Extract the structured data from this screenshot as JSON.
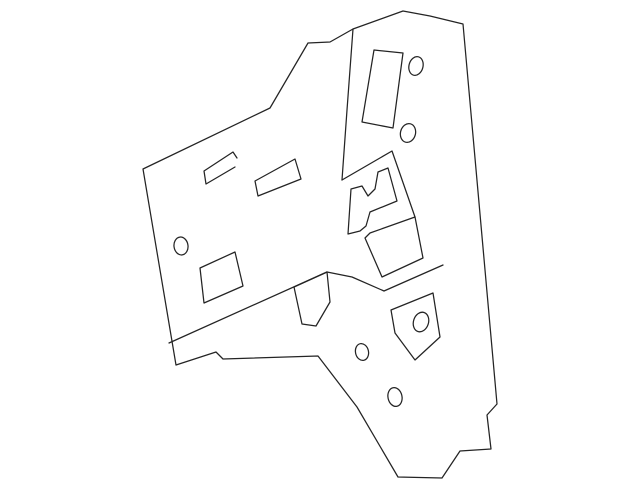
{
  "page": {
    "background_color": "#ffffff",
    "line_color": "#242424",
    "line_width": 1.25
  },
  "diagram": {
    "description": "line-art technical illustration of an irregular sheet-metal body panel with cutouts and holes",
    "canvas": {
      "width": 640,
      "height": 489
    },
    "paths": [
      {
        "name": "panel-outline",
        "d": "M143,169 L270,108 L308,43 L330,42 L353,29 L403,11 L430,16 L463,24 L497,404 L487,415 L491,449 L460,451 L442,478 L398,477 L357,407 L318,356 L223,359 L216,352 L176,365 Z"
      },
      {
        "name": "fold-line",
        "d": "M353,29 L347,110 L342,180"
      },
      {
        "name": "flag-line",
        "d": "M342,180 L392,151 L415,217"
      },
      {
        "name": "window-cutout",
        "d": "M374,50 L403,53 L393,128 L362,122 Z"
      },
      {
        "name": "hook-bracket",
        "d": "M237,158 L233,152 L204,171 L206,184 L235,167"
      },
      {
        "name": "vent-parallelogram",
        "d": "M255,181 L295,159 L301,179 L258,196 Z"
      },
      {
        "name": "access-rectangle",
        "d": "M200,268 L235,252 L243,286 L204,303 Z"
      },
      {
        "name": "latch-bracket",
        "d": "M351,189 L362,186 L368,196 L375,189 L378,172 L388,168 L397,201 L370,212 L366,226 L360,231 L348,234 Z"
      },
      {
        "name": "latch-face",
        "d": "M370,233 L415,217 L423,258 L382,277 L365,238 Z"
      },
      {
        "name": "flange-line",
        "d": "M169,343 L327,272"
      },
      {
        "name": "lower-tab",
        "d": "M294,287 L327,272 L330,302 L316,326 L302,324 Z"
      },
      {
        "name": "notch-line",
        "d": "M327,272 L352,277 L384,291 L443,265"
      },
      {
        "name": "striker-pentagon",
        "d": "M391,310 L433,293 L440,337 L415,360 L395,333 Z"
      }
    ],
    "holes": [
      {
        "name": "hole-top-right",
        "cx": 416,
        "cy": 66,
        "rx": 7,
        "ry": 9.5,
        "angle": 15
      },
      {
        "name": "hole-upper-mid",
        "cx": 408,
        "cy": 133,
        "rx": 7.5,
        "ry": 9.5,
        "angle": 15
      },
      {
        "name": "hole-left",
        "cx": 181,
        "cy": 246,
        "rx": 7,
        "ry": 9,
        "angle": -8
      },
      {
        "name": "hole-pentagon",
        "cx": 421,
        "cy": 322,
        "rx": 7.5,
        "ry": 10,
        "angle": 18
      },
      {
        "name": "hole-lower-left",
        "cx": 362,
        "cy": 352,
        "rx": 6.5,
        "ry": 8.5,
        "angle": -12
      },
      {
        "name": "hole-bottom",
        "cx": 395,
        "cy": 397,
        "rx": 7,
        "ry": 9.5,
        "angle": -12
      }
    ]
  }
}
